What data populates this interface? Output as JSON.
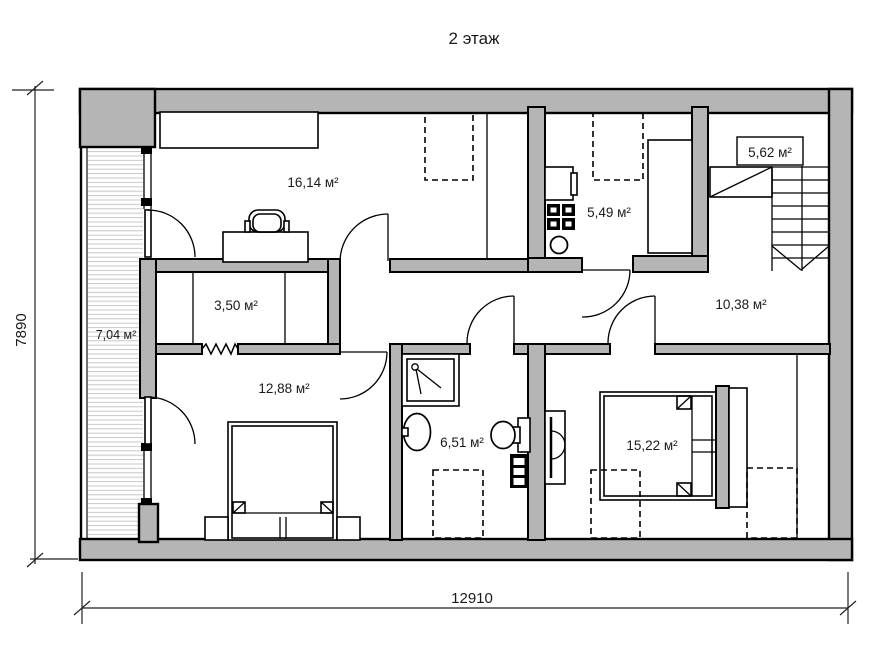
{
  "title": "2 этаж",
  "dimensions": {
    "width_label": "12910",
    "height_label": "7890"
  },
  "rooms": {
    "study": {
      "area": "16,14 м²"
    },
    "utility": {
      "area": "5,49 м²"
    },
    "stairs": {
      "area": "5,62 м²"
    },
    "closet": {
      "area": "3,50 м²"
    },
    "hall": {
      "area": "10,38 м²"
    },
    "balcony": {
      "area": "7,04 м²"
    },
    "bedroom1": {
      "area": "12,88 м²"
    },
    "bathroom": {
      "area": "6,51 м²"
    },
    "bedroom2": {
      "area": "15,22 м²"
    }
  }
}
